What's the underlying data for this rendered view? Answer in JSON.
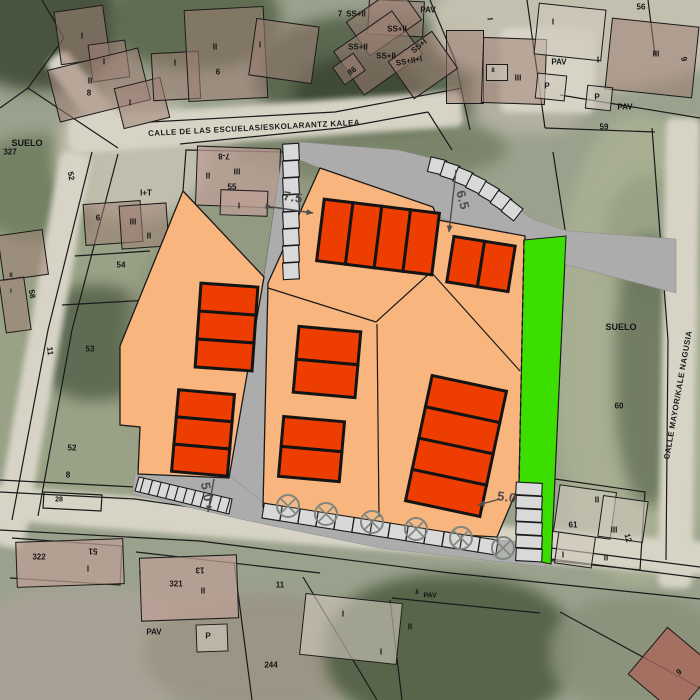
{
  "colors": {
    "plan_orange": "#F8B57D",
    "building_red": "#EE3D00",
    "green_zone": "#3CDE00",
    "road_gray": "#ACACAC",
    "stall_gray": "#D9D9D9",
    "line_black": "#1A1A1A",
    "dim_gray": "#4D4D4D"
  },
  "street_names": {
    "top": "CALLE DE LAS ESCUELAS/ESKOLARANTZ KALEA",
    "right": "CALLE MAYOR/KALE NAGUSIA"
  },
  "dimension_values": [
    "7.5",
    "6.5",
    "5.0",
    "5.0"
  ],
  "zone_labels": [
    "SUELO",
    "SUELO"
  ],
  "labels": [
    {
      "t": "I",
      "x": 82,
      "y": 36
    },
    {
      "t": "I",
      "x": 104,
      "y": 62
    },
    {
      "t": "II",
      "x": 90,
      "y": 81
    },
    {
      "t": "8",
      "x": 89,
      "y": 93
    },
    {
      "t": "I",
      "x": 130,
      "y": 103
    },
    {
      "t": "SUELO",
      "x": 27,
      "y": 143,
      "s": 9
    },
    {
      "t": "327",
      "x": 10,
      "y": 152
    },
    {
      "t": "52",
      "x": 71,
      "y": 176,
      "r": 80
    },
    {
      "t": "I",
      "x": 175,
      "y": 63
    },
    {
      "t": "II",
      "x": 215,
      "y": 47
    },
    {
      "t": "6",
      "x": 218,
      "y": 72
    },
    {
      "t": "I",
      "x": 260,
      "y": 45
    },
    {
      "t": "7",
      "x": 340,
      "y": 14
    },
    {
      "t": "PAV",
      "x": 428,
      "y": 10
    },
    {
      "t": "SS+II",
      "x": 356,
      "y": 14
    },
    {
      "t": "SS+II",
      "x": 397,
      "y": 29
    },
    {
      "t": "SS+II",
      "x": 358,
      "y": 47
    },
    {
      "t": "SS+II",
      "x": 386,
      "y": 56
    },
    {
      "t": "SS+II+I",
      "x": 409,
      "y": 61,
      "r": -10
    },
    {
      "t": "SS+I",
      "x": 419,
      "y": 46,
      "r": -40
    },
    {
      "t": "86",
      "x": 352,
      "y": 71,
      "r": -35
    },
    {
      "t": "I",
      "x": 490,
      "y": 19,
      "r": 85
    },
    {
      "t": "8",
      "x": 493,
      "y": 71,
      "s": 6
    },
    {
      "t": "III",
      "x": 518,
      "y": 78
    },
    {
      "t": "I",
      "x": 553,
      "y": 22
    },
    {
      "t": "56",
      "x": 641,
      "y": 7
    },
    {
      "t": "PAV",
      "x": 559,
      "y": 62
    },
    {
      "t": "P",
      "x": 547,
      "y": 86
    },
    {
      "t": "I",
      "x": 598,
      "y": 60
    },
    {
      "t": "III",
      "x": 656,
      "y": 54
    },
    {
      "t": "9",
      "x": 684,
      "y": 59,
      "r": 80
    },
    {
      "t": "P",
      "x": 597,
      "y": 97
    },
    {
      "t": "PAV",
      "x": 625,
      "y": 107
    },
    {
      "t": "59",
      "x": 604,
      "y": 127
    },
    {
      "t": "I+T",
      "x": 146,
      "y": 193
    },
    {
      "t": "7-8",
      "x": 224,
      "y": 156,
      "r": 180
    },
    {
      "t": "II",
      "x": 208,
      "y": 176
    },
    {
      "t": "III",
      "x": 237,
      "y": 172
    },
    {
      "t": "55",
      "x": 232,
      "y": 187
    },
    {
      "t": "I",
      "x": 239,
      "y": 206
    },
    {
      "t": "6",
      "x": 98,
      "y": 218
    },
    {
      "t": "III",
      "x": 133,
      "y": 222
    },
    {
      "t": "II",
      "x": 149,
      "y": 236
    },
    {
      "t": "54",
      "x": 121,
      "y": 265
    },
    {
      "t": "II",
      "x": 11,
      "y": 276,
      "s": 6
    },
    {
      "t": "I",
      "x": 11,
      "y": 292,
      "s": 6
    },
    {
      "t": "58",
      "x": 32,
      "y": 294,
      "r": 80
    },
    {
      "t": "53",
      "x": 90,
      "y": 349
    },
    {
      "t": "11",
      "x": 50,
      "y": 351,
      "r": 85
    },
    {
      "t": "SUELO",
      "x": 621,
      "y": 327,
      "s": 9
    },
    {
      "t": "60",
      "x": 619,
      "y": 406
    },
    {
      "t": "52",
      "x": 72,
      "y": 448
    },
    {
      "t": "8",
      "x": 68,
      "y": 475
    },
    {
      "t": "28",
      "x": 59,
      "y": 500,
      "s": 7
    },
    {
      "t": "322",
      "x": 39,
      "y": 557
    },
    {
      "t": "51",
      "x": 93,
      "y": 551,
      "r": 180
    },
    {
      "t": "I",
      "x": 88,
      "y": 569
    },
    {
      "t": "I",
      "x": 140,
      "y": 574
    },
    {
      "t": "13",
      "x": 200,
      "y": 570,
      "r": 180
    },
    {
      "t": "321",
      "x": 176,
      "y": 584
    },
    {
      "t": "II",
      "x": 203,
      "y": 591
    },
    {
      "t": "PAV",
      "x": 154,
      "y": 632
    },
    {
      "t": "P",
      "x": 208,
      "y": 636
    },
    {
      "t": "11",
      "x": 280,
      "y": 585
    },
    {
      "t": "244",
      "x": 271,
      "y": 665
    },
    {
      "t": "I",
      "x": 343,
      "y": 614
    },
    {
      "t": "8",
      "x": 417,
      "y": 593,
      "s": 6
    },
    {
      "t": "PAV",
      "x": 430,
      "y": 596,
      "s": 7
    },
    {
      "t": "II",
      "x": 410,
      "y": 627
    },
    {
      "t": "I",
      "x": 381,
      "y": 652
    },
    {
      "t": "II",
      "x": 597,
      "y": 500
    },
    {
      "t": "61",
      "x": 573,
      "y": 525
    },
    {
      "t": "III",
      "x": 614,
      "y": 530
    },
    {
      "t": "12",
      "x": 628,
      "y": 538,
      "r": 75
    },
    {
      "t": "I",
      "x": 563,
      "y": 555
    },
    {
      "t": "II",
      "x": 606,
      "y": 558
    },
    {
      "t": "9",
      "x": 679,
      "y": 672,
      "r": -35
    },
    {
      "t": "CALLE DE LAS ESCUELAS/ESKOLARANTZ KALEA",
      "x": 254,
      "y": 128,
      "r": -3,
      "cls": "street",
      "name": "street-name-top"
    },
    {
      "t": "CALLE MAYOR/KALE NAGUSIA",
      "x": 678,
      "y": 395,
      "r": -80,
      "cls": "street",
      "name": "street-name-right"
    },
    {
      "t": "7.5",
      "x": 293,
      "y": 197,
      "r": 9,
      "cls": "dim",
      "name": "dimension-label"
    },
    {
      "t": "6.5",
      "x": 463,
      "y": 200,
      "r": 75,
      "cls": "dim",
      "name": "dimension-label"
    },
    {
      "t": "5.0",
      "x": 207,
      "y": 492,
      "r": 80,
      "cls": "dim",
      "name": "dimension-label"
    },
    {
      "t": "5.0",
      "x": 507,
      "y": 497,
      "r": 8,
      "cls": "dim",
      "name": "dimension-label"
    }
  ]
}
